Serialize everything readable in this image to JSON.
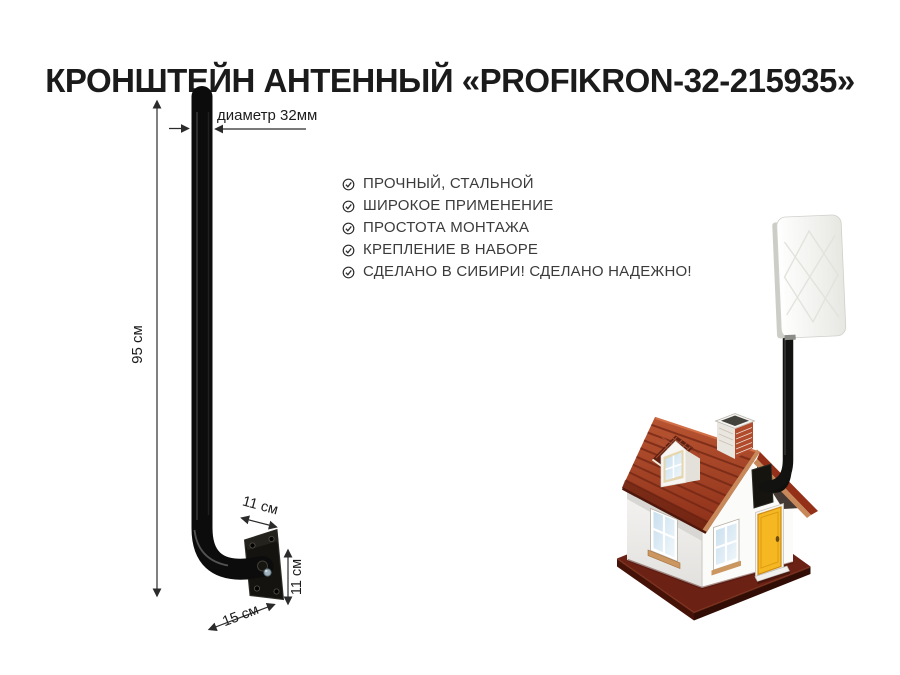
{
  "title": "КРОНШТЕЙН АНТЕННЫЙ «PROFIKRON-32-215935»",
  "features": {
    "bullet_icon": "check-circle-icon",
    "items": [
      "ПРОЧНЫЙ, СТАЛЬНОЙ",
      "ШИРОКОЕ ПРИМЕНЕНИЕ",
      "ПРОСТОТА МОНТАЖА",
      "КРЕПЛЕНИЕ В НАБОРЕ",
      "СДЕЛАНО В СИБИРИ! СДЕЛАНО НАДЕЖНО!"
    ]
  },
  "diagram": {
    "labels": {
      "height": "95 см",
      "diameter": "диаметр 32мм",
      "plate_width": "11 см",
      "plate_height": "11 см",
      "arm_depth": "15 см"
    }
  },
  "illustration": {
    "colors": {
      "pole": "#0d0d0d",
      "roof": "#a8432a",
      "roof_trim": "#c8895a",
      "door": "#f5b722",
      "base_slab": "#6b2114",
      "antenna_panel": "#f2f2ee",
      "window_glass": "#d5e7f2"
    }
  }
}
